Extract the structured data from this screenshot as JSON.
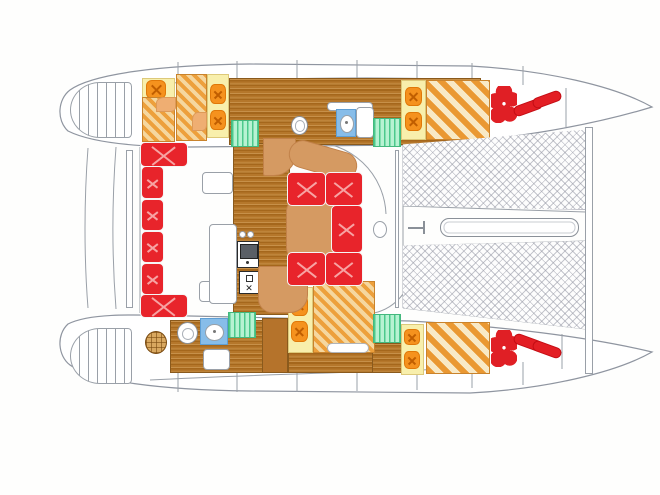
{
  "title": "Catamaran interior layout floor plan (top view)",
  "canvas": {
    "width": 660,
    "height": 495
  },
  "palette": {
    "cushion_red": "#e8242b",
    "gear_red": "#e31e24",
    "pillow_orange": "#f5921e",
    "pillow_yellow": "#f8efac",
    "settee_tan": "#d59a62",
    "wood_floor": "#b5772b",
    "mattress_stripe_orange": "#eda03c",
    "mattress_stripe_cream": "#f5d79f",
    "steps_green": "#4cc98c",
    "vanity_blue": "#87bde9",
    "outline_gray": "#9aa0a8",
    "net_gray": "#9698a5",
    "background": "#fefefd"
  },
  "items": [
    {
      "n": "hull-top-floor",
      "c": "wood",
      "x": 229,
      "y": 78,
      "w": 252,
      "h": 67
    },
    {
      "n": "salon-floor",
      "c": "wood",
      "x": 233,
      "y": 143,
      "w": 57,
      "h": 172
    },
    {
      "n": "hull-bottom-floor-aft",
      "c": "wood",
      "x": 170,
      "y": 320,
      "w": 93,
      "h": 53
    },
    {
      "n": "hull-bottom-floor-mid",
      "c": "wood",
      "x": 288,
      "y": 351,
      "w": 111,
      "h": 22
    },
    {
      "n": "hull-bottom-floor-fwd",
      "c": "wood",
      "x": 372,
      "y": 343,
      "w": 30,
      "h": 30
    },
    {
      "n": "stern-steps-top-hull",
      "c": "steps-oval",
      "x": 70,
      "y": 82,
      "w": 62,
      "h": 56
    },
    {
      "n": "stern-steps-bottom-hull",
      "c": "steps-oval",
      "x": 70,
      "y": 328,
      "w": 62,
      "h": 56
    },
    {
      "n": "hull-top-aft-berth-head",
      "c": "pillow-strip",
      "x": 142,
      "y": 78,
      "w": 33,
      "h": 25
    },
    {
      "n": "hull-top-aft-berth-pillow",
      "c": "pillow",
      "x": 146,
      "y": 80,
      "w": 20,
      "h": 19
    },
    {
      "n": "hull-top-aft-berth-mattress",
      "c": "berth",
      "x": 142,
      "y": 97,
      "w": 33,
      "h": 45
    },
    {
      "n": "hull-top-aft-berth-corner",
      "c": "tan-patch",
      "x": 156,
      "y": 97,
      "w": 20,
      "h": 15
    },
    {
      "n": "hull-top-mid-berth-mattress",
      "c": "berth",
      "x": 176,
      "y": 74,
      "w": 31,
      "h": 67
    },
    {
      "n": "hull-top-mid-berth-corner",
      "c": "tan-patch",
      "x": 192,
      "y": 112,
      "w": 15,
      "h": 19
    },
    {
      "n": "hull-top-mid-berth-head",
      "c": "pillow-strip",
      "x": 207,
      "y": 74,
      "w": 22,
      "h": 64
    },
    {
      "n": "hull-top-mid-berth-pillow-1",
      "c": "pillow",
      "x": 210,
      "y": 84,
      "w": 16,
      "h": 20
    },
    {
      "n": "hull-top-mid-berth-pillow-2",
      "c": "pillow",
      "x": 210,
      "y": 110,
      "w": 16,
      "h": 20
    },
    {
      "n": "hull-top-aft-companionway-steps",
      "c": "green-steps",
      "x": 231,
      "y": 120,
      "w": 28,
      "h": 27
    },
    {
      "n": "hull-top-head-counter",
      "c": "white-box",
      "x": 327,
      "y": 102,
      "w": 46,
      "h": 9
    },
    {
      "n": "hull-top-head-sink-vanity",
      "c": "vanity",
      "x": 336,
      "y": 109,
      "w": 20,
      "h": 28
    },
    {
      "n": "hull-top-head-cabinet",
      "c": "white-box",
      "x": 356,
      "y": 107,
      "w": 18,
      "h": 31
    },
    {
      "n": "hull-top-head-toilet",
      "c": "toilet",
      "x": 291,
      "y": 116,
      "w": 17,
      "h": 19
    },
    {
      "n": "hull-top-fwd-companionway-steps",
      "c": "green-steps",
      "x": 373,
      "y": 118,
      "w": 28,
      "h": 29
    },
    {
      "n": "hull-top-fwd-berth-head",
      "c": "pillow-strip",
      "x": 401,
      "y": 80,
      "w": 25,
      "h": 60
    },
    {
      "n": "hull-top-fwd-berth-pillow-1",
      "c": "pillow",
      "x": 405,
      "y": 87,
      "w": 17,
      "h": 19
    },
    {
      "n": "hull-top-fwd-berth-pillow-2",
      "c": "pillow",
      "x": 405,
      "y": 112,
      "w": 17,
      "h": 19
    },
    {
      "n": "hull-top-fwd-berth-mattress",
      "c": "berth-wide",
      "x": 426,
      "y": 80,
      "w": 64,
      "h": 60
    },
    {
      "n": "hull-bottom-wardrobe",
      "c": "cabinet",
      "x": 262,
      "y": 318,
      "w": 26,
      "h": 55
    },
    {
      "n": "hull-bottom-mid-berth-head",
      "c": "pillow-strip",
      "x": 288,
      "y": 287,
      "w": 25,
      "h": 66
    },
    {
      "n": "hull-bottom-mid-berth-pillow-1",
      "c": "pillow",
      "x": 291,
      "y": 295,
      "w": 17,
      "h": 21
    },
    {
      "n": "hull-bottom-mid-berth-pillow-2",
      "c": "pillow",
      "x": 291,
      "y": 321,
      "w": 17,
      "h": 21
    },
    {
      "n": "hull-bottom-mid-berth-mattress",
      "c": "berth",
      "x": 313,
      "y": 281,
      "w": 62,
      "h": 72
    },
    {
      "n": "hull-bottom-mid-berth-bolster",
      "c": "capsule",
      "x": 327,
      "y": 343,
      "w": 42,
      "h": 10
    },
    {
      "n": "hull-bottom-shower-seat",
      "c": "round-table",
      "x": 145,
      "y": 331,
      "w": 22,
      "h": 23
    },
    {
      "n": "hull-bottom-head-toilet",
      "c": "toilet-oval",
      "x": 177,
      "y": 322,
      "w": 21,
      "h": 22
    },
    {
      "n": "hull-bottom-head-sink-vanity",
      "c": "vanity",
      "x": 200,
      "y": 318,
      "w": 28,
      "h": 27
    },
    {
      "n": "hull-bottom-aft-companionway-steps",
      "c": "green-steps",
      "x": 228,
      "y": 312,
      "w": 28,
      "h": 26
    },
    {
      "n": "hull-bottom-fwd-companionway-steps",
      "c": "green-steps",
      "x": 373,
      "y": 314,
      "w": 28,
      "h": 29
    },
    {
      "n": "hull-bottom-fwd-berth-head",
      "c": "pillow-strip",
      "x": 401,
      "y": 324,
      "w": 23,
      "h": 51
    },
    {
      "n": "hull-bottom-fwd-berth-pillow-1",
      "c": "pillow",
      "x": 404,
      "y": 329,
      "w": 16,
      "h": 16
    },
    {
      "n": "hull-bottom-fwd-berth-pillow-2",
      "c": "pillow",
      "x": 404,
      "y": 351,
      "w": 16,
      "h": 18
    },
    {
      "n": "hull-bottom-fwd-berth-mattress",
      "c": "berth-wide",
      "x": 426,
      "y": 322,
      "w": 64,
      "h": 52
    },
    {
      "n": "salon-cabinet-1",
      "c": "white-box",
      "x": 202,
      "y": 172,
      "w": 31,
      "h": 22
    },
    {
      "n": "salon-cabinet-2",
      "c": "white-box",
      "x": 199,
      "y": 281,
      "w": 26,
      "h": 21
    },
    {
      "n": "salon-cabinet-3",
      "c": "white-box",
      "x": 203,
      "y": 349,
      "w": 27,
      "h": 21
    },
    {
      "n": "galley-counter",
      "c": "white-box",
      "x": 209,
      "y": 224,
      "w": 28,
      "h": 80
    },
    {
      "n": "galley-burner-1",
      "c": "small-circle",
      "x": 239,
      "y": 231,
      "w": 7,
      "h": 7
    },
    {
      "n": "galley-burner-2",
      "c": "small-circle",
      "x": 247,
      "y": 231,
      "w": 7,
      "h": 7
    },
    {
      "n": "galley-sink-unit",
      "c": "galley-sink",
      "x": 237,
      "y": 241,
      "w": 22,
      "h": 27
    },
    {
      "n": "galley-stove-oven",
      "c": "galley-stove",
      "x": 239,
      "y": 271,
      "w": 20,
      "h": 23
    },
    {
      "n": "dinette-backrest-upper",
      "c": "tan-a",
      "x": 263,
      "y": 138,
      "w": 33,
      "h": 38
    },
    {
      "n": "dinette-backrest-curve",
      "c": "tan-b",
      "x": 288,
      "y": 146,
      "w": 70,
      "h": 28,
      "r": 16
    },
    {
      "n": "dinette-table",
      "c": "tan-table",
      "x": 286,
      "y": 199,
      "w": 48,
      "h": 61
    },
    {
      "n": "dinette-bench-lower",
      "c": "tan-d",
      "x": 258,
      "y": 266,
      "w": 50,
      "h": 47
    },
    {
      "n": "dinette-cushion-top-left",
      "c": "red",
      "x": 287,
      "y": 172,
      "w": 39,
      "h": 34
    },
    {
      "n": "dinette-cushion-top-right",
      "c": "red",
      "x": 325,
      "y": 172,
      "w": 38,
      "h": 34
    },
    {
      "n": "dinette-cushion-right",
      "c": "red",
      "x": 331,
      "y": 205,
      "w": 32,
      "h": 48
    },
    {
      "n": "dinette-cushion-bottom-right",
      "c": "red",
      "x": 325,
      "y": 252,
      "w": 38,
      "h": 34
    },
    {
      "n": "dinette-cushion-bottom-left",
      "c": "red",
      "x": 287,
      "y": 252,
      "w": 39,
      "h": 34
    },
    {
      "n": "cockpit-settee-cushion-1",
      "c": "red",
      "x": 140,
      "y": 142,
      "w": 48,
      "h": 25
    },
    {
      "n": "cockpit-settee-cushion-2",
      "c": "red",
      "x": 141,
      "y": 166,
      "w": 23,
      "h": 33
    },
    {
      "n": "cockpit-settee-cushion-3",
      "c": "red",
      "x": 141,
      "y": 199,
      "w": 23,
      "h": 32
    },
    {
      "n": "cockpit-settee-cushion-4",
      "c": "red",
      "x": 141,
      "y": 231,
      "w": 23,
      "h": 32
    },
    {
      "n": "cockpit-settee-cushion-5",
      "c": "red",
      "x": 141,
      "y": 263,
      "w": 23,
      "h": 32
    },
    {
      "n": "cockpit-settee-cushion-6",
      "c": "red",
      "x": 140,
      "y": 294,
      "w": 48,
      "h": 24
    },
    {
      "n": "cockpit-aft-bench",
      "c": "outline-thin",
      "x": 126,
      "y": 150,
      "w": 7,
      "h": 158
    },
    {
      "n": "salon-deck-hatch",
      "c": "oval-outline",
      "x": 373,
      "y": 221,
      "w": 14,
      "h": 17
    },
    {
      "n": "salon-door-track",
      "c": "outline-thin",
      "x": 395,
      "y": 150,
      "w": 4,
      "h": 158
    },
    {
      "n": "trampoline-net-top",
      "c": "tramp",
      "x": 402,
      "y": 128,
      "w": 186,
      "h": 82,
      "cp": "polygon(0.5% 20%, 99% 2%, 99% 100%, 0.5% 95%)"
    },
    {
      "n": "trampoline-net-bottom",
      "c": "tramp",
      "x": 402,
      "y": 240,
      "w": 186,
      "h": 92,
      "cp": "polygon(0.5% 6%, 99% 1%, 99% 97%, 0.5% 74%)"
    },
    {
      "n": "forward-crossbeam",
      "c": "outline-thin",
      "x": 585,
      "y": 127,
      "w": 8,
      "h": 247
    },
    {
      "n": "bowsprit-plank",
      "c": "plank",
      "x": 440,
      "y": 218,
      "w": 139,
      "h": 19
    },
    {
      "n": "anchor-windlass-icon",
      "c": "anchor-icon",
      "x": 408,
      "y": 220,
      "w": 26,
      "h": 15
    },
    {
      "n": "forepeak-top-cushion-cluster",
      "c": "red-flower",
      "x": 491,
      "y": 86,
      "w": 26,
      "h": 37
    },
    {
      "n": "forepeak-top-fender-1",
      "c": "red-capsule",
      "x": 513,
      "y": 102,
      "w": 30,
      "h": 11,
      "r": -20
    },
    {
      "n": "forepeak-top-fender-2",
      "c": "red-capsule",
      "x": 532,
      "y": 94,
      "w": 30,
      "h": 11,
      "r": -20
    },
    {
      "n": "forepeak-bottom-cushion-cluster",
      "c": "red-flower",
      "x": 491,
      "y": 330,
      "w": 26,
      "h": 37
    },
    {
      "n": "forepeak-bottom-fender-1",
      "c": "red-capsule",
      "x": 513,
      "y": 337,
      "w": 30,
      "h": 11,
      "r": 20
    },
    {
      "n": "forepeak-bottom-fender-2",
      "c": "red-capsule",
      "x": 532,
      "y": 344,
      "w": 30,
      "h": 11,
      "r": 20
    }
  ]
}
